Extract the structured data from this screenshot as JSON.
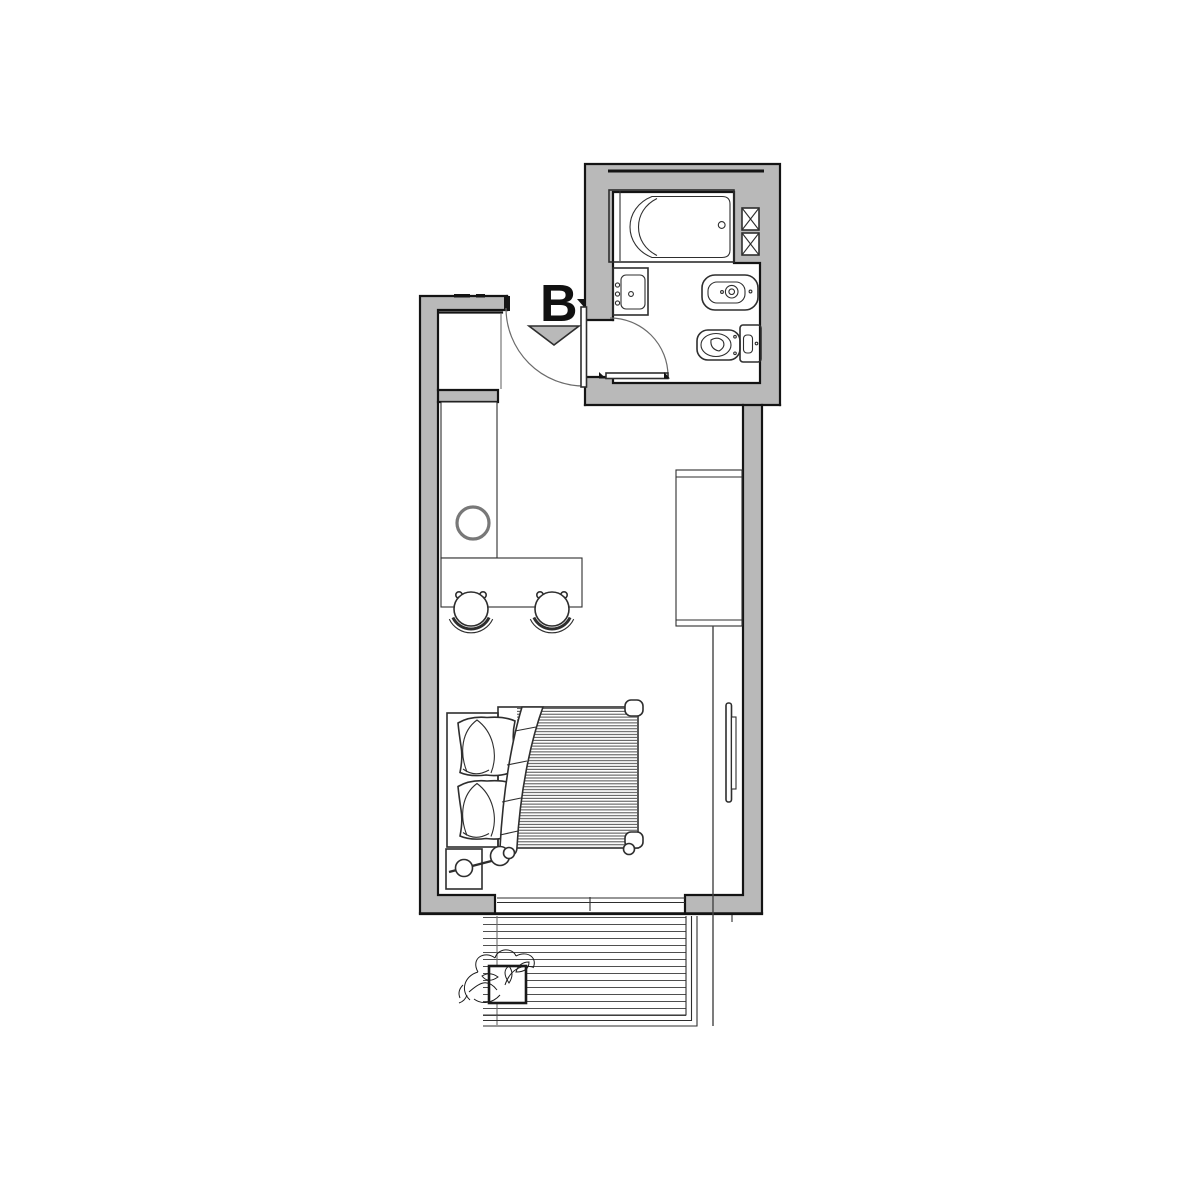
{
  "unit": {
    "label": "B"
  },
  "colors": {
    "background": "#ffffff",
    "wall_fill": "#b9b9b9",
    "wall_edge": "#141414",
    "fixture_line": "#2e2e2e",
    "thin_line": "#6b6b6b"
  },
  "fixtures": {
    "bathroom": [
      "bathtub",
      "vanity-sink",
      "bidet",
      "toilet",
      "shaft",
      "shaft"
    ],
    "main_room": [
      "entry-closet",
      "kitchen-counter",
      "kitchen-sink",
      "breakfast-bar",
      "bar-stool",
      "bar-stool",
      "wardrobe",
      "tv",
      "double-bed",
      "pillows",
      "duvet-roll",
      "nightstand",
      "reading-lamp"
    ],
    "balcony": [
      "wood-decking",
      "planter",
      "plant",
      "railing"
    ],
    "doors": [
      "entry-door",
      "bathroom-door",
      "sliding-balcony-door"
    ]
  }
}
